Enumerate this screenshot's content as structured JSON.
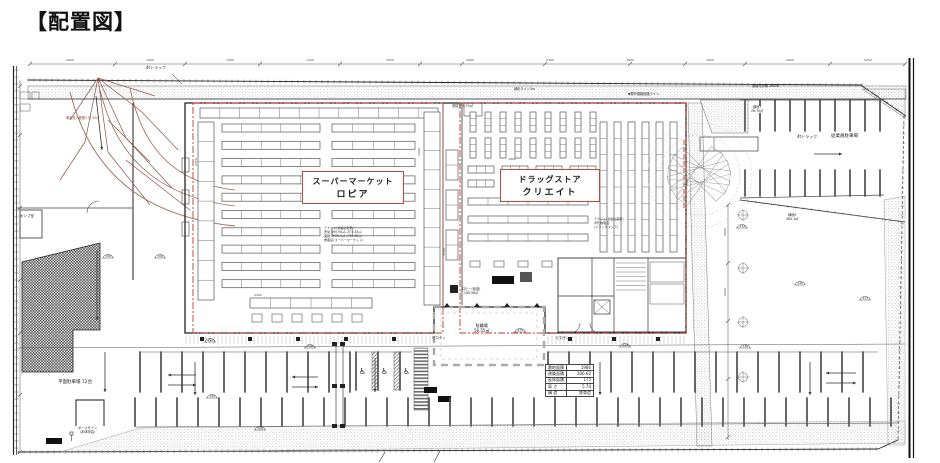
{
  "page": {
    "title": "【配置図】"
  },
  "colors": {
    "line": "#3a3a3a",
    "wall": "#222222",
    "red": "#c0392b",
    "red_box_border": "#c0473f",
    "brown": "#8a5443",
    "light_gray": "#9a9a9a",
    "stall": "#4d4d4d"
  },
  "labels": {
    "supermarket": {
      "line1": "スーパーマーケット",
      "line2": "ロピア"
    },
    "drugstore": {
      "line1": "ドラッグストア",
      "line2": "クリエイト"
    },
    "employee_parking": "従業員駐車場",
    "truck_4t": "4tトラック",
    "truck_4t_top": "4tトラック",
    "flat_parking": "平面駐車場 72台",
    "pump_room": "ポンプ室",
    "piloti_1": "ピロティ",
    "piloti_2": "ピロティ",
    "lobby_line1": "ロビー(仮設)",
    "lobby_line2": "109.56㎡",
    "bicycle_line1": "駐輪場",
    "bicycle_line2": "56.55㎡",
    "green7_line1": "緑地7",
    "green7_line2": "26.70㎡",
    "green5_line1": "緑地5",
    "green5_line2": "584.1㎡",
    "pole_sign_line1": "ポールサイン",
    "pole_sign_line2": "(本体申請)",
    "entry_note": "車両進入範囲273.30㎡",
    "vestibule": "風除室 9.75㎡",
    "road_note_1": "緑化ライン3m",
    "road_note_2": "道路境界線 20000",
    "road_note_3": "▼屋外避難経路ライン",
    "tenant_note_sm": [
      "テナント(仮設)(変更)",
      "売場 690.94㎡→574.43㎡",
      "面積 2525.3㎡→761.60㎡",
      "物販店(スーパーマーケット)"
    ],
    "tenant_note_ds": [
      "テナント(仮設)(変更)",
      "4号 物販店",
      "(ドラッグストア)"
    ]
  },
  "site_table": {
    "rows": [
      [
        "敷地面積",
        "1986"
      ],
      [
        "建築面積",
        "306.60"
      ],
      [
        "延床面積",
        "175"
      ],
      [
        "高 さ",
        "5.74"
      ],
      [
        "構 造",
        "鉄骨造"
      ]
    ]
  },
  "dims": {
    "values": [
      "2000",
      "1500",
      "7400",
      "1100",
      "3500",
      "2490",
      "2400",
      "1500",
      "5000",
      "2000",
      "5250",
      "2450",
      "2400",
      "3500",
      "3000",
      "6000",
      "6000",
      "2400",
      "1800"
    ]
  },
  "levels": [
    "-300",
    "-300",
    "-220",
    "-300",
    "-475",
    "-125",
    "-144",
    "-140",
    "-300",
    "-180",
    "-115",
    "-300"
  ]
}
